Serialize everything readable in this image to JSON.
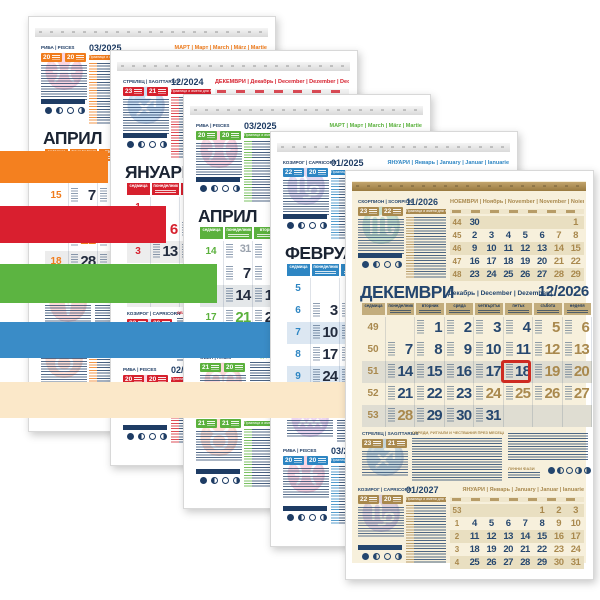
{
  "page": {
    "background": "#ffffff"
  },
  "bands": [
    {
      "name": "orange",
      "color": "#F4801F"
    },
    {
      "name": "red",
      "color": "#D91F2F"
    },
    {
      "name": "green",
      "color": "#5CB441"
    },
    {
      "name": "blue",
      "color": "#3A8CC7"
    },
    {
      "name": "cream",
      "color": "#FBE8C9"
    }
  ],
  "common": {
    "day_names": [
      "седмица",
      "понеделник",
      "вторник",
      "сряда",
      "четвъртък",
      "петък",
      "събота",
      "неделя"
    ],
    "list_caption": "Празници и имени дни през месеца",
    "rituals_caption": "ОБРЕДИ, РИТУАЛИ И ЧЕСТВАНИЯ ПРЕЗ МЕСЕЦА",
    "moon_caption": "ЛУННИ ФАЗИ"
  },
  "sheets": [
    {
      "id": "april-2025-orange",
      "accent": "#F07C1C",
      "dateColor": "#232C3E",
      "navy": "#1E3C64",
      "dayHdrBg": "#F07C1C",
      "dayHdrFg": "#FFFFFF",
      "stripe": "#ECECEC",
      "stripeMini": "#F4E3D2",
      "contentBg": "#FFFFFF",
      "stripTop": "#F4F4F4",
      "stripBot": "#D9D9D9",
      "titleColor": "#1B2433",
      "title": {
        "bg": "АПРИЛ",
        "subs": "Апрель | April | April | Aprilie",
        "year": ""
      },
      "zodiac_top": {
        "bg": "РИБА",
        "en": "PISCES",
        "symbol": "♓",
        "d1": "20",
        "d2": "20"
      },
      "zodiac_mid": {
        "bg": "ОВЕН",
        "en": "ARIES",
        "symbol": "♈",
        "d1": "21",
        "d2": "20"
      },
      "zodiac_bottom": {
        "bg": "ТЕЛЕЦ",
        "en": "TAURUS",
        "symbol": "♉",
        "d1": "21",
        "d2": "21"
      },
      "mini_top": {
        "caption": "03/2025",
        "months": "МАРТ | Март | March | März | Martie",
        "weeks": [],
        "rows": [],
        "accents": []
      },
      "mini_bottom": {
        "caption": "05/2025",
        "months": "МАЙ | Май | May | Mai | Mai",
        "weeks": [],
        "rows": [],
        "accents": []
      },
      "main": {
        "weeks": [
          14,
          15,
          16,
          17,
          18
        ],
        "rows": [
          [
            31,
            1,
            2,
            3,
            4,
            5,
            6
          ],
          [
            7,
            8,
            9,
            10,
            11,
            12,
            13
          ],
          [
            14,
            15,
            16,
            17,
            18,
            19,
            20
          ],
          [
            21,
            22,
            23,
            24,
            25,
            26,
            27
          ],
          [
            28,
            29,
            30,
            "",
            "",
            "",
            ""
          ]
        ],
        "accents": [
          5,
          6,
          12,
          13,
          18,
          19,
          20,
          21,
          26,
          27
        ],
        "lead": [
          31
        ],
        "boxed": null
      }
    },
    {
      "id": "january-2025-red",
      "accent": "#D6212E",
      "dateColor": "#232C3E",
      "navy": "#1E3C64",
      "dayHdrBg": "#D6212E",
      "dayHdrFg": "#FFFFFF",
      "stripe": "#EDEDED",
      "stripeMini": "#F6DCDC",
      "contentBg": "#FFFFFF",
      "stripTop": "#F4F4F4",
      "stripBot": "#D9D9D9",
      "titleColor": "#1B2433",
      "title": {
        "bg": "ЯНУАРИ",
        "subs": "Январь | January | Januar | Ianuarie",
        "year": ""
      },
      "zodiac_top": {
        "bg": "СТРЕЛЕЦ",
        "en": "SAGITTARIUS",
        "symbol": "♐",
        "d1": "23",
        "d2": "21"
      },
      "zodiac_mid": {
        "bg": "КОЗИРОГ",
        "en": "CAPRICORN",
        "symbol": "♑",
        "d1": "22",
        "d2": "20"
      },
      "zodiac_bottom": {
        "bg": "РИБА",
        "en": "PISCES",
        "symbol": "♓",
        "d1": "20",
        "d2": "20"
      },
      "mini_top": {
        "caption": "12/2024",
        "months": "ДЕКЕМВРИ | Декабрь | December | Dezember | Decembrie",
        "weeks": [],
        "rows": [],
        "accents": []
      },
      "mini_bottom": {
        "caption": "02/2025",
        "months": "ФЕВРУАРИ | Февраль | February | Februar | Februarie",
        "weeks": [],
        "rows": [],
        "accents": []
      },
      "main": {
        "weeks": [
          1,
          2,
          3,
          4,
          5
        ],
        "rows": [
          [
            "",
            "",
            1,
            2,
            3,
            4,
            5
          ],
          [
            6,
            7,
            8,
            9,
            10,
            11,
            12
          ],
          [
            13,
            14,
            15,
            16,
            17,
            18,
            19
          ],
          [
            20,
            21,
            22,
            23,
            24,
            25,
            26
          ],
          [
            27,
            28,
            29,
            30,
            31,
            "",
            ""
          ]
        ],
        "accents": [
          1,
          4,
          5,
          6,
          11,
          12,
          18,
          19,
          25,
          26
        ],
        "lead": [],
        "boxed": null
      }
    },
    {
      "id": "april-2025-green",
      "accent": "#5BB13D",
      "dateColor": "#232C3E",
      "navy": "#1E3C64",
      "dayHdrBg": "#5BB13D",
      "dayHdrFg": "#FFFFFF",
      "stripe": "#E4E7E9",
      "stripeMini": "#DFF0D8",
      "contentBg": "#FFFFFF",
      "stripTop": "#F4F4F4",
      "stripBot": "#D9D9D9",
      "titleColor": "#1B2433",
      "title": {
        "bg": "АПРИЛ",
        "subs": "Апрель | April | April | Aprilie",
        "year": ""
      },
      "zodiac_top": {
        "bg": "РИБА",
        "en": "PISCES",
        "symbol": "♓",
        "d1": "20",
        "d2": "20"
      },
      "zodiac_mid": {
        "bg": "ОВЕН",
        "en": "ARIES",
        "symbol": "♈",
        "d1": "21",
        "d2": "20"
      },
      "zodiac_bottom": {
        "bg": "ТЕЛЕЦ",
        "en": "TAURUS",
        "symbol": "♉",
        "d1": "21",
        "d2": "21"
      },
      "mini_top": {
        "caption": "03/2025",
        "months": "МАРТ | Март | March | März | Martie",
        "weeks": [],
        "rows": [],
        "accents": []
      },
      "mini_bottom": {
        "caption": "05/2025",
        "months": "МАЙ | Май | May | Mai | Mai",
        "weeks": [],
        "rows": [],
        "accents": []
      },
      "main": {
        "weeks": [
          14,
          15,
          16,
          17,
          18
        ],
        "rows": [
          [
            31,
            1,
            2,
            3,
            4,
            5,
            6
          ],
          [
            7,
            8,
            9,
            10,
            11,
            12,
            13
          ],
          [
            14,
            15,
            16,
            17,
            18,
            19,
            20
          ],
          [
            21,
            22,
            23,
            24,
            25,
            26,
            27
          ],
          [
            28,
            29,
            30,
            "",
            "",
            "",
            ""
          ]
        ],
        "accents": [
          5,
          6,
          12,
          13,
          18,
          19,
          20,
          21,
          26,
          27
        ],
        "lead": [
          31
        ],
        "boxed": null
      }
    },
    {
      "id": "february-2025-blue",
      "accent": "#2E86C3",
      "dateColor": "#232C3E",
      "navy": "#1E3C64",
      "dayHdrBg": "#2E86C3",
      "dayHdrFg": "#FFFFFF",
      "stripe": "#DCE7F2",
      "stripeMini": "#DCE9F5",
      "contentBg": "#FFFFFF",
      "stripTop": "#F4F4F4",
      "stripBot": "#D9D9D9",
      "titleColor": "#1B2433",
      "title": {
        "bg": "ФЕВРУАРИ",
        "subs": "Февраль | February | Februar | Februarie",
        "year": ""
      },
      "zodiac_top": {
        "bg": "КОЗИРОГ",
        "en": "CAPRICORN",
        "symbol": "♑",
        "d1": "22",
        "d2": "20"
      },
      "zodiac_mid": {
        "bg": "ВОДОЛЕЙ",
        "en": "AQUARIUS",
        "symbol": "♒",
        "d1": "21",
        "d2": "19"
      },
      "zodiac_bottom": {
        "bg": "РИБА",
        "en": "PISCES",
        "symbol": "♓",
        "d1": "20",
        "d2": "20"
      },
      "mini_top": {
        "caption": "01/2025",
        "months": "ЯНУАРИ | Январь | January | Januar | Ianuarie",
        "weeks": [],
        "rows": [],
        "accents": []
      },
      "mini_bottom": {
        "caption": "03/2025",
        "months": "МАРТ | Март | March | März | Martie",
        "weeks": [],
        "rows": [],
        "accents": []
      },
      "main": {
        "weeks": [
          5,
          6,
          7,
          8,
          9
        ],
        "rows": [
          [
            "",
            "",
            "",
            "",
            "",
            1,
            2
          ],
          [
            3,
            4,
            5,
            6,
            7,
            8,
            9
          ],
          [
            10,
            11,
            12,
            13,
            14,
            15,
            16
          ],
          [
            17,
            18,
            19,
            20,
            21,
            22,
            23
          ],
          [
            24,
            25,
            26,
            27,
            28,
            "",
            ""
          ]
        ],
        "accents": [
          1,
          2,
          8,
          9,
          15,
          16,
          22,
          23
        ],
        "lead": [],
        "boxed": null
      }
    },
    {
      "id": "december-2026-tan",
      "accent": "#A9894E",
      "dateColor": "#27486F",
      "navy": "#24466E",
      "dayHdrBg": "#C3AD7D",
      "dayHdrFg": "#203C5F",
      "stripe": "#DFDDD2",
      "stripeMini": "#E9DFC1",
      "contentBg": "#F7F0DC",
      "stripTop": "#C2A46C",
      "stripBot": "#997A40",
      "titleColor": "#24466E",
      "title": {
        "bg": "ДЕКЕМВРИ",
        "subs": "Декабрь | December | Dezember | Decembrie",
        "year": "12/2026"
      },
      "zodiac_top": {
        "bg": "СКОРПИОН",
        "en": "SCORPION",
        "symbol": "♏",
        "d1": "23",
        "d2": "22"
      },
      "zodiac_mid": {
        "bg": "СТРЕЛЕЦ",
        "en": "SAGITTARIUS",
        "symbol": "♐",
        "d1": "23",
        "d2": "21"
      },
      "zodiac_bottom": {
        "bg": "КОЗИРОГ",
        "en": "CAPRICORN",
        "symbol": "♑",
        "d1": "22",
        "d2": "20"
      },
      "mini_top": {
        "caption": "11/2026",
        "months": "НОЕМВРИ | Ноябрь | November | November | Noiembrie",
        "weeks": [
          44,
          45,
          46,
          47,
          48
        ],
        "rows": [
          [
            30,
            "",
            "",
            "",
            "",
            "",
            1
          ],
          [
            2,
            3,
            4,
            5,
            6,
            7,
            8
          ],
          [
            9,
            10,
            11,
            12,
            13,
            14,
            15
          ],
          [
            16,
            17,
            18,
            19,
            20,
            21,
            22
          ],
          [
            23,
            24,
            25,
            26,
            27,
            28,
            29
          ]
        ],
        "accents": [
          1,
          7,
          8,
          14,
          15,
          21,
          22,
          28,
          29
        ]
      },
      "mini_bottom": {
        "caption": "01/2027",
        "months": "ЯНУАРИ | Январь | January | Januar | Ianuarie",
        "weeks": [
          53,
          1,
          2,
          3,
          4
        ],
        "rows": [
          [
            "",
            "",
            "",
            "",
            1,
            2,
            3
          ],
          [
            4,
            5,
            6,
            7,
            8,
            9,
            10
          ],
          [
            11,
            12,
            13,
            14,
            15,
            16,
            17
          ],
          [
            18,
            19,
            20,
            21,
            22,
            23,
            24
          ],
          [
            25,
            26,
            27,
            28,
            29,
            30,
            31
          ]
        ],
        "accents": [
          1,
          2,
          3,
          9,
          10,
          16,
          17,
          23,
          24,
          30,
          31
        ]
      },
      "main": {
        "weeks": [
          49,
          50,
          51,
          52,
          53
        ],
        "rows": [
          [
            "",
            1,
            2,
            3,
            4,
            5,
            6
          ],
          [
            7,
            8,
            9,
            10,
            11,
            12,
            13
          ],
          [
            14,
            15,
            16,
            17,
            18,
            19,
            20
          ],
          [
            21,
            22,
            23,
            24,
            25,
            26,
            27
          ],
          [
            28,
            29,
            30,
            31,
            "",
            "",
            ""
          ]
        ],
        "accents": [
          5,
          6,
          12,
          13,
          19,
          20,
          24,
          25,
          26,
          27,
          28
        ],
        "lead": [],
        "boxed": 18,
        "box_color": "#CE2B21"
      }
    }
  ]
}
